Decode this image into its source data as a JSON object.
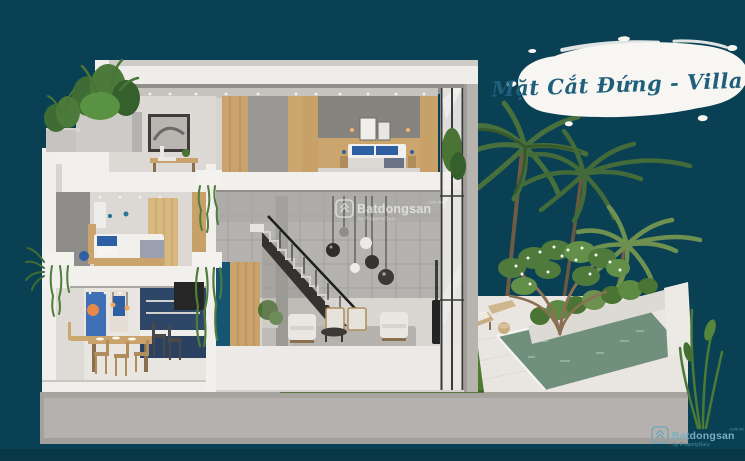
{
  "title": {
    "text": "Mặt Cắt Đứng - Villa A"
  },
  "watermark": {
    "brand": "Batdongsan",
    "suffix": ".com.vn",
    "byline": "by PropertyGuru"
  },
  "footer_logo": {
    "brand": "Batdongsan",
    "suffix": ".com.vn",
    "byline": "by PropertyGuru"
  },
  "colors": {
    "background": "#0a4054",
    "footer_strip": "#083848",
    "plinth": "#b4b1ae",
    "wall_white": "#f1efec",
    "concrete": "#b7b4b0",
    "wood": "#c9a36b",
    "grass": "#4e7c2f",
    "foliage": "#4a7434",
    "pool_water": "#70907c",
    "pillow_navy": "#2e3f66",
    "bed_blue": "#2e5fa3",
    "kitchen_cabinet": "#2e4668",
    "flame": "#f29a3c",
    "brush_plate": "#f7f6f3",
    "title_ink": "#1f5f7b",
    "watermark_text": "#ffffff",
    "footer_text": "#79aec3"
  }
}
